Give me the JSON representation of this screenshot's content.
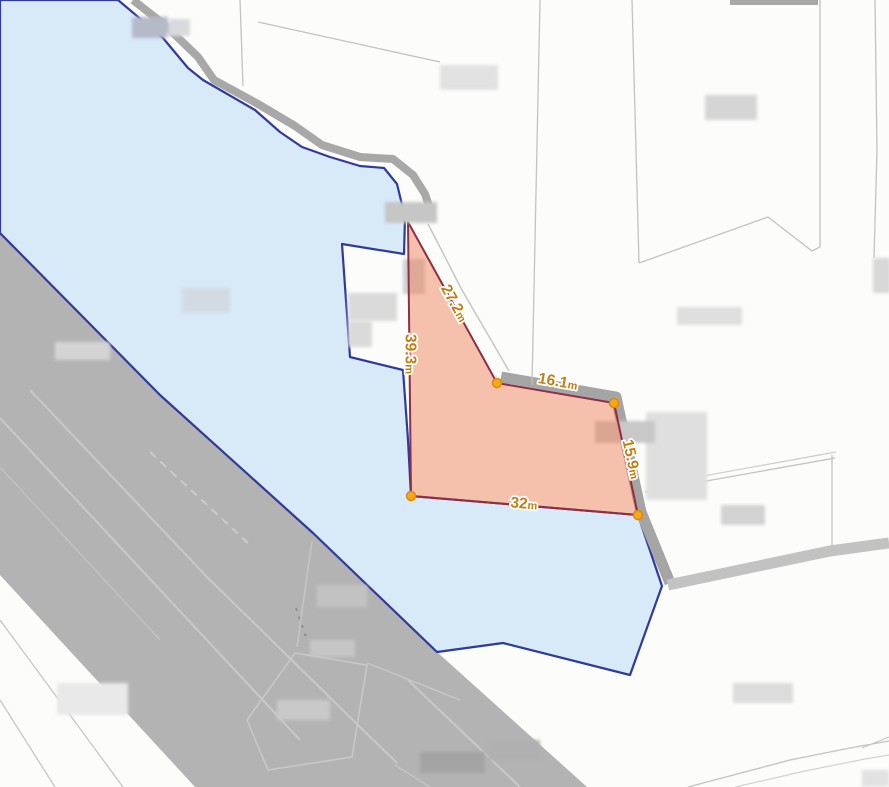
{
  "map": {
    "background": "#fcfcfa",
    "colors": {
      "water_fill": "#d8e9f8",
      "water_stroke": "#2f3a9c",
      "road_fill": "#b3b3b3",
      "band_gray": "#a5a5a5",
      "parcel_line": "#c2c2c2",
      "overlay_fill": "#ef7b4d",
      "overlay_stroke": "#8f2e44",
      "vertex_fill": "#f7a71f",
      "vertex_stroke": "#da8c05",
      "label_color": "#c07f14",
      "label_halo": "#ffffff"
    },
    "layers": [
      {
        "t": "polygon",
        "name": "road-area-main",
        "interactable": false,
        "pts": "0,233 160,395 313,533 437,652 587,787 195,787 0,575",
        "fill": "#b3b3b3"
      },
      {
        "t": "pline",
        "name": "road-lane-line",
        "interactable": false,
        "pts": "30,390 207,577 360,727 397,763",
        "stroke": "#c9c9c9",
        "w": 2
      },
      {
        "t": "pline",
        "name": "road-lane-line",
        "interactable": false,
        "pts": "0,418 300,740",
        "stroke": "#c9c9c9",
        "w": 2
      },
      {
        "t": "pline",
        "name": "road-lane-line",
        "interactable": false,
        "pts": "0,467 160,640",
        "stroke": "#c2c2c2",
        "w": 1.5
      },
      {
        "t": "pline",
        "name": "road-lane-line",
        "interactable": false,
        "pts": "408,680 520,787",
        "stroke": "#c9c9c9",
        "w": 2
      },
      {
        "t": "pline",
        "name": "road-lane-line",
        "interactable": false,
        "pts": "395,765 430,787",
        "stroke": "#c4c4c4",
        "w": 1.5
      },
      {
        "t": "pline",
        "name": "road-dashed-line",
        "interactable": false,
        "pts": "150,452 248,543",
        "stroke": "#cccccc",
        "w": 2,
        "dash": "8 6"
      },
      {
        "t": "pline",
        "name": "road-dashed-line",
        "interactable": false,
        "pts": "296,608 306,637",
        "stroke": "#8f8f8f",
        "w": 2,
        "dash": "3 6"
      },
      {
        "t": "pline",
        "name": "parcel-line",
        "interactable": false,
        "pts": "312,541 297,647",
        "stroke": "#c6c6c6",
        "w": 1.5
      },
      {
        "t": "polygon",
        "name": "building-outline-on-road",
        "interactable": false,
        "pts": "295,653 367,665 352,757 268,770 247,720",
        "fill": "none",
        "stroke": "#c9c9c9",
        "w": 1.5
      },
      {
        "t": "pline",
        "name": "parcel-line",
        "interactable": false,
        "pts": "367,663 460,700",
        "stroke": "#c6c6c6",
        "w": 1.5
      },
      {
        "t": "polygon",
        "name": "water-area",
        "interactable": false,
        "pts": "0,0 118,0 163,38 188,68 203,80 255,110 280,132 302,147 330,157 360,166 384,168 397,184 405,217 404,254 342,244 350,357 403,370 408,440 411,496 638,515 662,586 630,675 503,643 437,652 313,533 160,395 0,233",
        "fill": "#d8e9f8",
        "stroke": "#2f3a9c",
        "w": 2.2
      },
      {
        "t": "pline",
        "name": "shore-road-band",
        "interactable": false,
        "pts": "133,0 166,26 198,57 214,80 258,104 295,126 322,145 360,157 393,159 413,175 425,194 431,212",
        "stroke": "#a8a8a8",
        "w": 8
      },
      {
        "t": "pline",
        "name": "roadside-band",
        "interactable": false,
        "pts": "501,377 616,397 641,512 670,583",
        "stroke": "#a5a5a5",
        "w": 11
      },
      {
        "t": "pline",
        "name": "roadside-band",
        "interactable": false,
        "pts": "668,585 830,551 889,543",
        "stroke": "#c2c2c2",
        "w": 11
      },
      {
        "t": "rect",
        "name": "road-edge-top",
        "interactable": false,
        "x": 730,
        "y": 0,
        "wd": 88,
        "h": 5,
        "fill": "#a8a8a8"
      },
      {
        "t": "pline",
        "name": "parcel-line",
        "interactable": false,
        "pts": "540,0 532,385",
        "stroke": "#c2c2c2",
        "w": 1.3
      },
      {
        "t": "pline",
        "name": "parcel-line",
        "interactable": false,
        "pts": "632,0 639,263",
        "stroke": "#c2c2c2",
        "w": 1.3
      },
      {
        "t": "pline",
        "name": "parcel-line",
        "interactable": false,
        "pts": "639,263 768,217 812,251 820,247",
        "stroke": "#c2c2c2",
        "w": 1.3
      },
      {
        "t": "pline",
        "name": "parcel-line",
        "interactable": false,
        "pts": "820,0 820,247",
        "stroke": "#c2c2c2",
        "w": 1.3
      },
      {
        "t": "pline",
        "name": "parcel-line",
        "interactable": false,
        "pts": "875,0 877,150 874,258",
        "stroke": "#c2c2c2",
        "w": 1.3
      },
      {
        "t": "pline",
        "name": "parcel-line",
        "interactable": false,
        "pts": "258,22 440,62",
        "stroke": "#c2c2c2",
        "w": 1.3
      },
      {
        "t": "pline",
        "name": "parcel-line",
        "interactable": false,
        "pts": "240,0 243,86",
        "stroke": "#c2c2c2",
        "w": 1.3
      },
      {
        "t": "pline",
        "name": "road-edge-line",
        "interactable": false,
        "pts": "428,224 462,290 509,371",
        "stroke": "#c6c6c6",
        "w": 1.5
      },
      {
        "t": "pline",
        "name": "parcel-line",
        "interactable": false,
        "pts": "645,492 835,458",
        "stroke": "#c2c2c2",
        "w": 1.3
      },
      {
        "t": "pline",
        "name": "parcel-line",
        "interactable": false,
        "pts": "648,486 836,452",
        "stroke": "#cccccc",
        "w": 1.2
      },
      {
        "t": "pline",
        "name": "parcel-line",
        "interactable": false,
        "pts": "832,455 832,548",
        "stroke": "#c2c2c2",
        "w": 1.3
      },
      {
        "t": "pline",
        "name": "parcel-line",
        "interactable": false,
        "pts": "0,620 123,787",
        "stroke": "#c6c6c6",
        "w": 1.3
      },
      {
        "t": "pline",
        "name": "parcel-line",
        "interactable": false,
        "pts": "0,700 55,787",
        "stroke": "#c6c6c6",
        "w": 1.3
      },
      {
        "t": "pline",
        "name": "road-curve-line",
        "interactable": false,
        "pts": "688,787 790,760 850,748 889,741",
        "stroke": "#c2c2c2",
        "w": 1.3
      },
      {
        "t": "pline",
        "name": "road-curve-line",
        "interactable": false,
        "pts": "735,787 805,771 865,759 889,755",
        "stroke": "#d2d2d2",
        "w": 1.2
      },
      {
        "t": "pline",
        "name": "parcel-line",
        "interactable": false,
        "pts": "862,748 889,737",
        "stroke": "#c6c6c6",
        "w": 1.2
      },
      {
        "t": "rect",
        "name": "building-block",
        "interactable": false,
        "x": 132,
        "y": 17,
        "wd": 36,
        "h": 21,
        "fill": "#b4bac8",
        "blur": true
      },
      {
        "t": "rect",
        "name": "building-block",
        "interactable": false,
        "x": 168,
        "y": 19,
        "wd": 22,
        "h": 17,
        "fill": "#d8dade",
        "blur": true
      },
      {
        "t": "rect",
        "name": "building-block",
        "interactable": false,
        "x": 348,
        "y": 293,
        "wd": 49,
        "h": 28,
        "fill": "#dadada",
        "blur": true
      },
      {
        "t": "rect",
        "name": "building-block",
        "interactable": false,
        "x": 348,
        "y": 321,
        "wd": 24,
        "h": 26,
        "fill": "#dadada",
        "blur": true
      },
      {
        "t": "rect",
        "name": "building-block",
        "interactable": false,
        "x": 403,
        "y": 259,
        "wd": 22,
        "h": 35,
        "fill": "#cfcfcf",
        "blur": true
      },
      {
        "t": "rect",
        "name": "building-block",
        "interactable": false,
        "x": 646,
        "y": 412,
        "wd": 61,
        "h": 88,
        "fill": "#dfdfdf",
        "blur": true
      },
      {
        "t": "rect",
        "name": "building-block",
        "interactable": false,
        "x": 595,
        "y": 421,
        "wd": 60,
        "h": 22,
        "fill": "#c8c8c8",
        "blur": true
      },
      {
        "t": "rect",
        "name": "building-block",
        "interactable": false,
        "x": 721,
        "y": 505,
        "wd": 44,
        "h": 20,
        "fill": "#d2d2d2",
        "blur": true
      },
      {
        "t": "rect",
        "name": "building-block",
        "interactable": false,
        "x": 677,
        "y": 307,
        "wd": 65,
        "h": 18,
        "fill": "#dfdfdf",
        "blur": true
      },
      {
        "t": "rect",
        "name": "building-block",
        "interactable": false,
        "x": 705,
        "y": 95,
        "wd": 52,
        "h": 25,
        "fill": "#d5d5d5",
        "blur": true
      },
      {
        "t": "rect",
        "name": "building-block",
        "interactable": false,
        "x": 440,
        "y": 65,
        "wd": 58,
        "h": 25,
        "fill": "#e2e2e2",
        "blur": true
      },
      {
        "t": "rect",
        "name": "building-block",
        "interactable": false,
        "x": 873,
        "y": 258,
        "wd": 17,
        "h": 35,
        "fill": "#d8d8d8",
        "blur": true
      },
      {
        "t": "rect",
        "name": "building-block",
        "interactable": false,
        "x": 733,
        "y": 683,
        "wd": 60,
        "h": 20,
        "fill": "#dcdcdc",
        "blur": true
      },
      {
        "t": "rect",
        "name": "building-block",
        "interactable": false,
        "x": 862,
        "y": 770,
        "wd": 27,
        "h": 17,
        "fill": "#e2e2e2",
        "blur": true
      },
      {
        "t": "rect",
        "name": "building-block",
        "interactable": false,
        "x": 55,
        "y": 342,
        "wd": 55,
        "h": 18,
        "fill": "#d4d4d4",
        "blur": true
      },
      {
        "t": "rect",
        "name": "building-block",
        "interactable": false,
        "x": 57,
        "y": 683,
        "wd": 71,
        "h": 32,
        "fill": "#e9e9e9",
        "blur": true
      },
      {
        "t": "rect",
        "name": "building-block",
        "interactable": false,
        "x": 182,
        "y": 288,
        "wd": 48,
        "h": 25,
        "fill": "#d2dbe4",
        "blur": true
      },
      {
        "t": "rect",
        "name": "building-block",
        "interactable": false,
        "x": 317,
        "y": 585,
        "wd": 50,
        "h": 22,
        "fill": "#c2c2c2",
        "blur": true
      },
      {
        "t": "rect",
        "name": "building-block",
        "interactable": false,
        "x": 310,
        "y": 640,
        "wd": 45,
        "h": 17,
        "fill": "#c6c6c6",
        "blur": true
      },
      {
        "t": "rect",
        "name": "building-block",
        "interactable": false,
        "x": 277,
        "y": 700,
        "wd": 53,
        "h": 20,
        "fill": "#c9c9c9",
        "blur": true
      },
      {
        "t": "rect",
        "name": "building-block",
        "interactable": false,
        "x": 420,
        "y": 752,
        "wd": 65,
        "h": 21,
        "fill": "#a4a4a4",
        "blur": true
      },
      {
        "t": "rect",
        "name": "building-block",
        "interactable": false,
        "x": 488,
        "y": 740,
        "wd": 52,
        "h": 20,
        "fill": "#b0b0b0",
        "blur": true
      },
      {
        "t": "polygon",
        "name": "measurement-polygon",
        "interactable": true,
        "pts": "408,222 497,383 614,403 638,515 411,496",
        "fill": "#ef7b4d",
        "fillOpacity": 0.45,
        "stroke": "#8f2e44",
        "w": 2
      },
      {
        "t": "rect",
        "name": "building-block",
        "interactable": false,
        "x": 385,
        "y": 202,
        "wd": 52,
        "h": 21,
        "fill": "#c6c6c6",
        "blur": true
      },
      {
        "t": "circle",
        "name": "vertex-handle",
        "interactable": true,
        "cx": 497,
        "cy": 383,
        "r": 4.5,
        "fill": "#f7a71f",
        "stroke": "#da8c05",
        "w": 1.5
      },
      {
        "t": "circle",
        "name": "vertex-handle",
        "interactable": true,
        "cx": 614,
        "cy": 403,
        "r": 4.5,
        "fill": "#f7a71f",
        "stroke": "#da8c05",
        "w": 1.5
      },
      {
        "t": "circle",
        "name": "vertex-handle",
        "interactable": true,
        "cx": 638,
        "cy": 515,
        "r": 4.5,
        "fill": "#f7a71f",
        "stroke": "#da8c05",
        "w": 1.5
      },
      {
        "t": "circle",
        "name": "vertex-handle",
        "interactable": true,
        "cx": 411,
        "cy": 496,
        "r": 4.5,
        "fill": "#f7a71f",
        "stroke": "#da8c05",
        "w": 1.5
      },
      {
        "t": "label",
        "name": "measurement-label-27-2m",
        "interactable": false,
        "value": "27.2",
        "unit": "m",
        "x": 455,
        "y": 303,
        "rot": 61,
        "size": 15.5,
        "unitSize": 11,
        "fill": "#c07f14",
        "halo": "#ffffff"
      },
      {
        "t": "label",
        "name": "measurement-label-39-3m",
        "interactable": false,
        "value": "39.3",
        "unit": "m",
        "x": 411,
        "y": 354,
        "rot": 90,
        "size": 15.5,
        "unitSize": 11,
        "fill": "#c07f14",
        "halo": "#ffffff"
      },
      {
        "t": "label",
        "name": "measurement-label-16-1m",
        "interactable": false,
        "value": "16.1",
        "unit": "m",
        "x": 558,
        "y": 381,
        "rot": 10,
        "size": 15.5,
        "unitSize": 11,
        "fill": "#c07f14",
        "halo": "#ffffff"
      },
      {
        "t": "label",
        "name": "measurement-label-15-9m",
        "interactable": false,
        "value": "15.9",
        "unit": "m",
        "x": 632,
        "y": 459,
        "rot": 78,
        "size": 15.5,
        "unitSize": 11,
        "fill": "#c07f14",
        "halo": "#ffffff"
      },
      {
        "t": "label",
        "name": "measurement-label-32m",
        "interactable": false,
        "value": "32",
        "unit": "m",
        "x": 524,
        "y": 503,
        "rot": 5,
        "size": 15.5,
        "unitSize": 11,
        "fill": "#c07f14",
        "halo": "#ffffff"
      }
    ]
  }
}
